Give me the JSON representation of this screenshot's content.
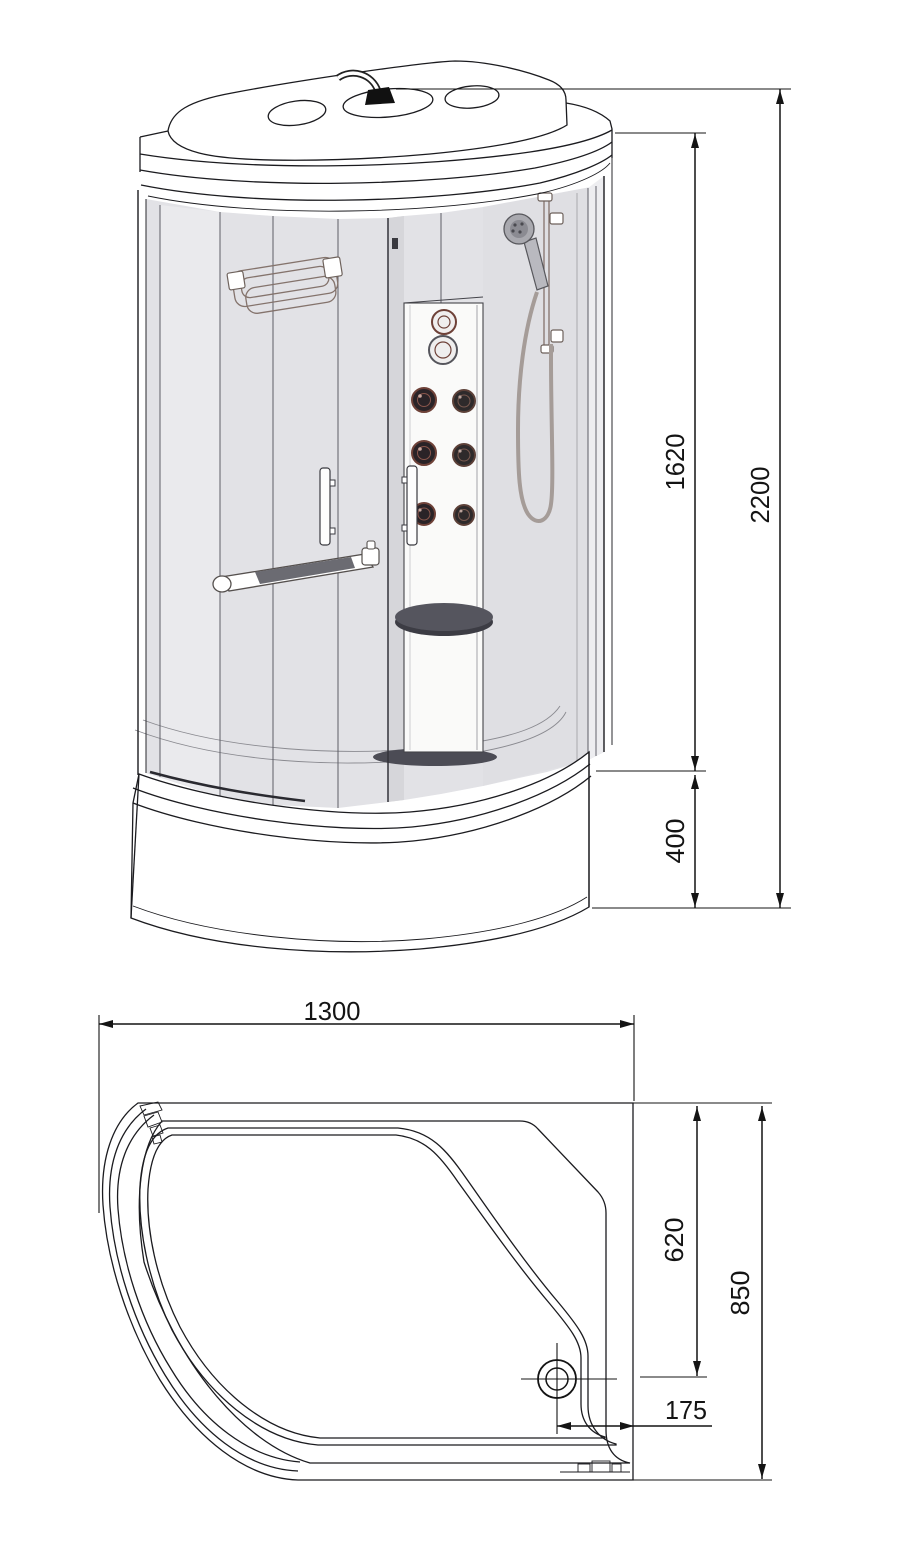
{
  "drawing": {
    "title": "Shower cabin technical drawing",
    "views": {
      "front": "front elevation",
      "plan": "top plan"
    }
  },
  "dims": {
    "front": {
      "inner_height": "1620",
      "overall_height": "2200",
      "tray_height": "400"
    },
    "plan": {
      "overall_width": "1300",
      "drain_depth": "620",
      "overall_depth": "850",
      "drain_offset": "175"
    }
  },
  "colors": {
    "line": "#1b1b1f",
    "dimension": "#141414",
    "glass": "#e2e2e6",
    "glass_dark": "#d6d6da",
    "glass_light": "#ededf0",
    "column": "#fafaf9",
    "seat": "#4c4c55",
    "jet_ring": "#6e4138",
    "jet_fill": "#2a2327",
    "hardware": "#84736c"
  }
}
